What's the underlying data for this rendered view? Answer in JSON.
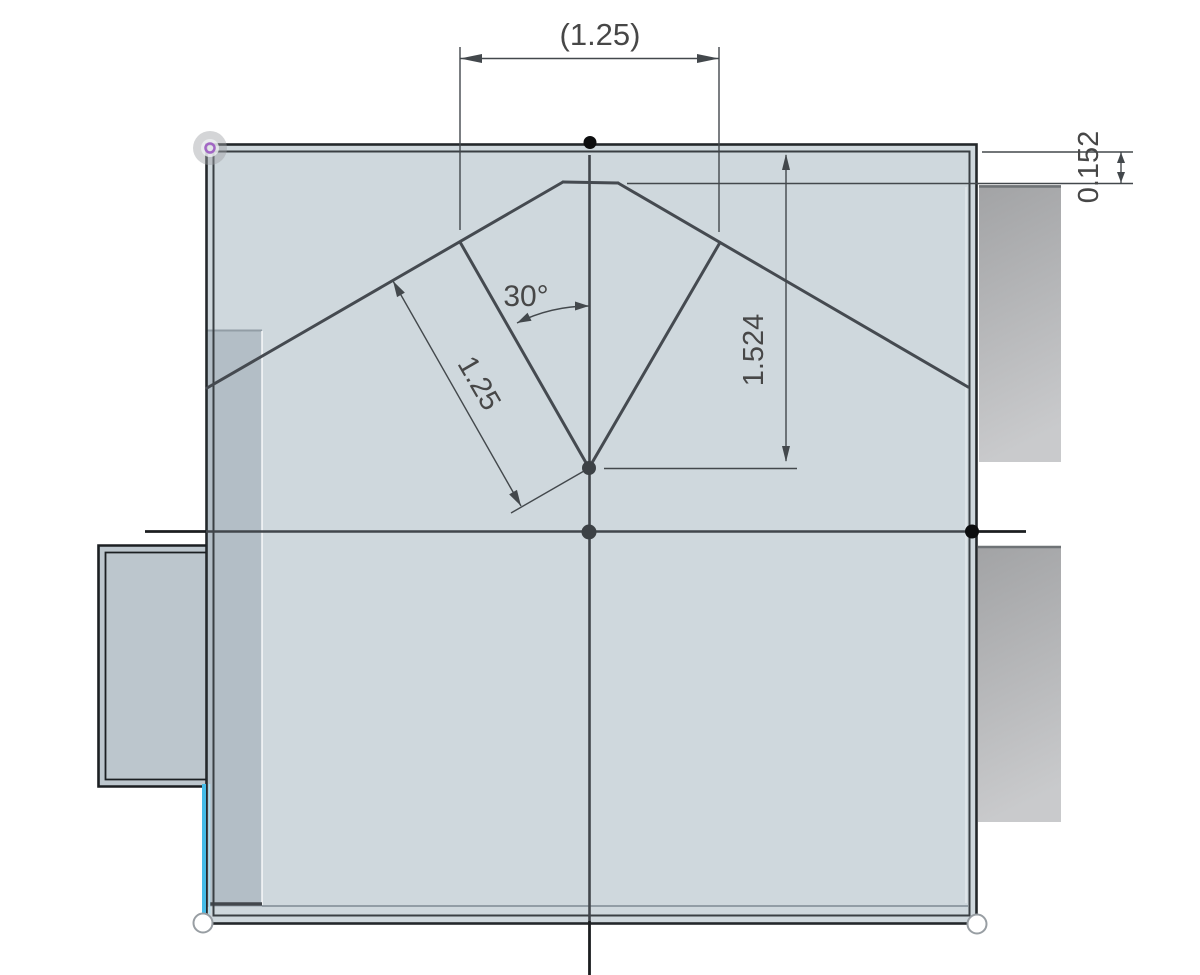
{
  "canvas": {
    "width": 1200,
    "height": 975,
    "background": "#ffffff"
  },
  "dimensions": {
    "top_width": "(1.25)",
    "thickness": "0.152",
    "angle": "30°",
    "slant_length": "1.25",
    "depth": "1.524"
  },
  "colors": {
    "face": "#cfd8dd",
    "face_shaded": "#b3bec6",
    "face_protrusion": "#bcc6cd",
    "solid_gray_top": "#a2a3a5",
    "solid_gray_bottom": "#c9cacc",
    "sketch_line": "#454a50",
    "border": "#24282b",
    "dimension_line": "#43484c",
    "dimension_text": "#474747",
    "selected_edge": "#45bce8",
    "highlighted_point_ring": "#a266c4"
  }
}
